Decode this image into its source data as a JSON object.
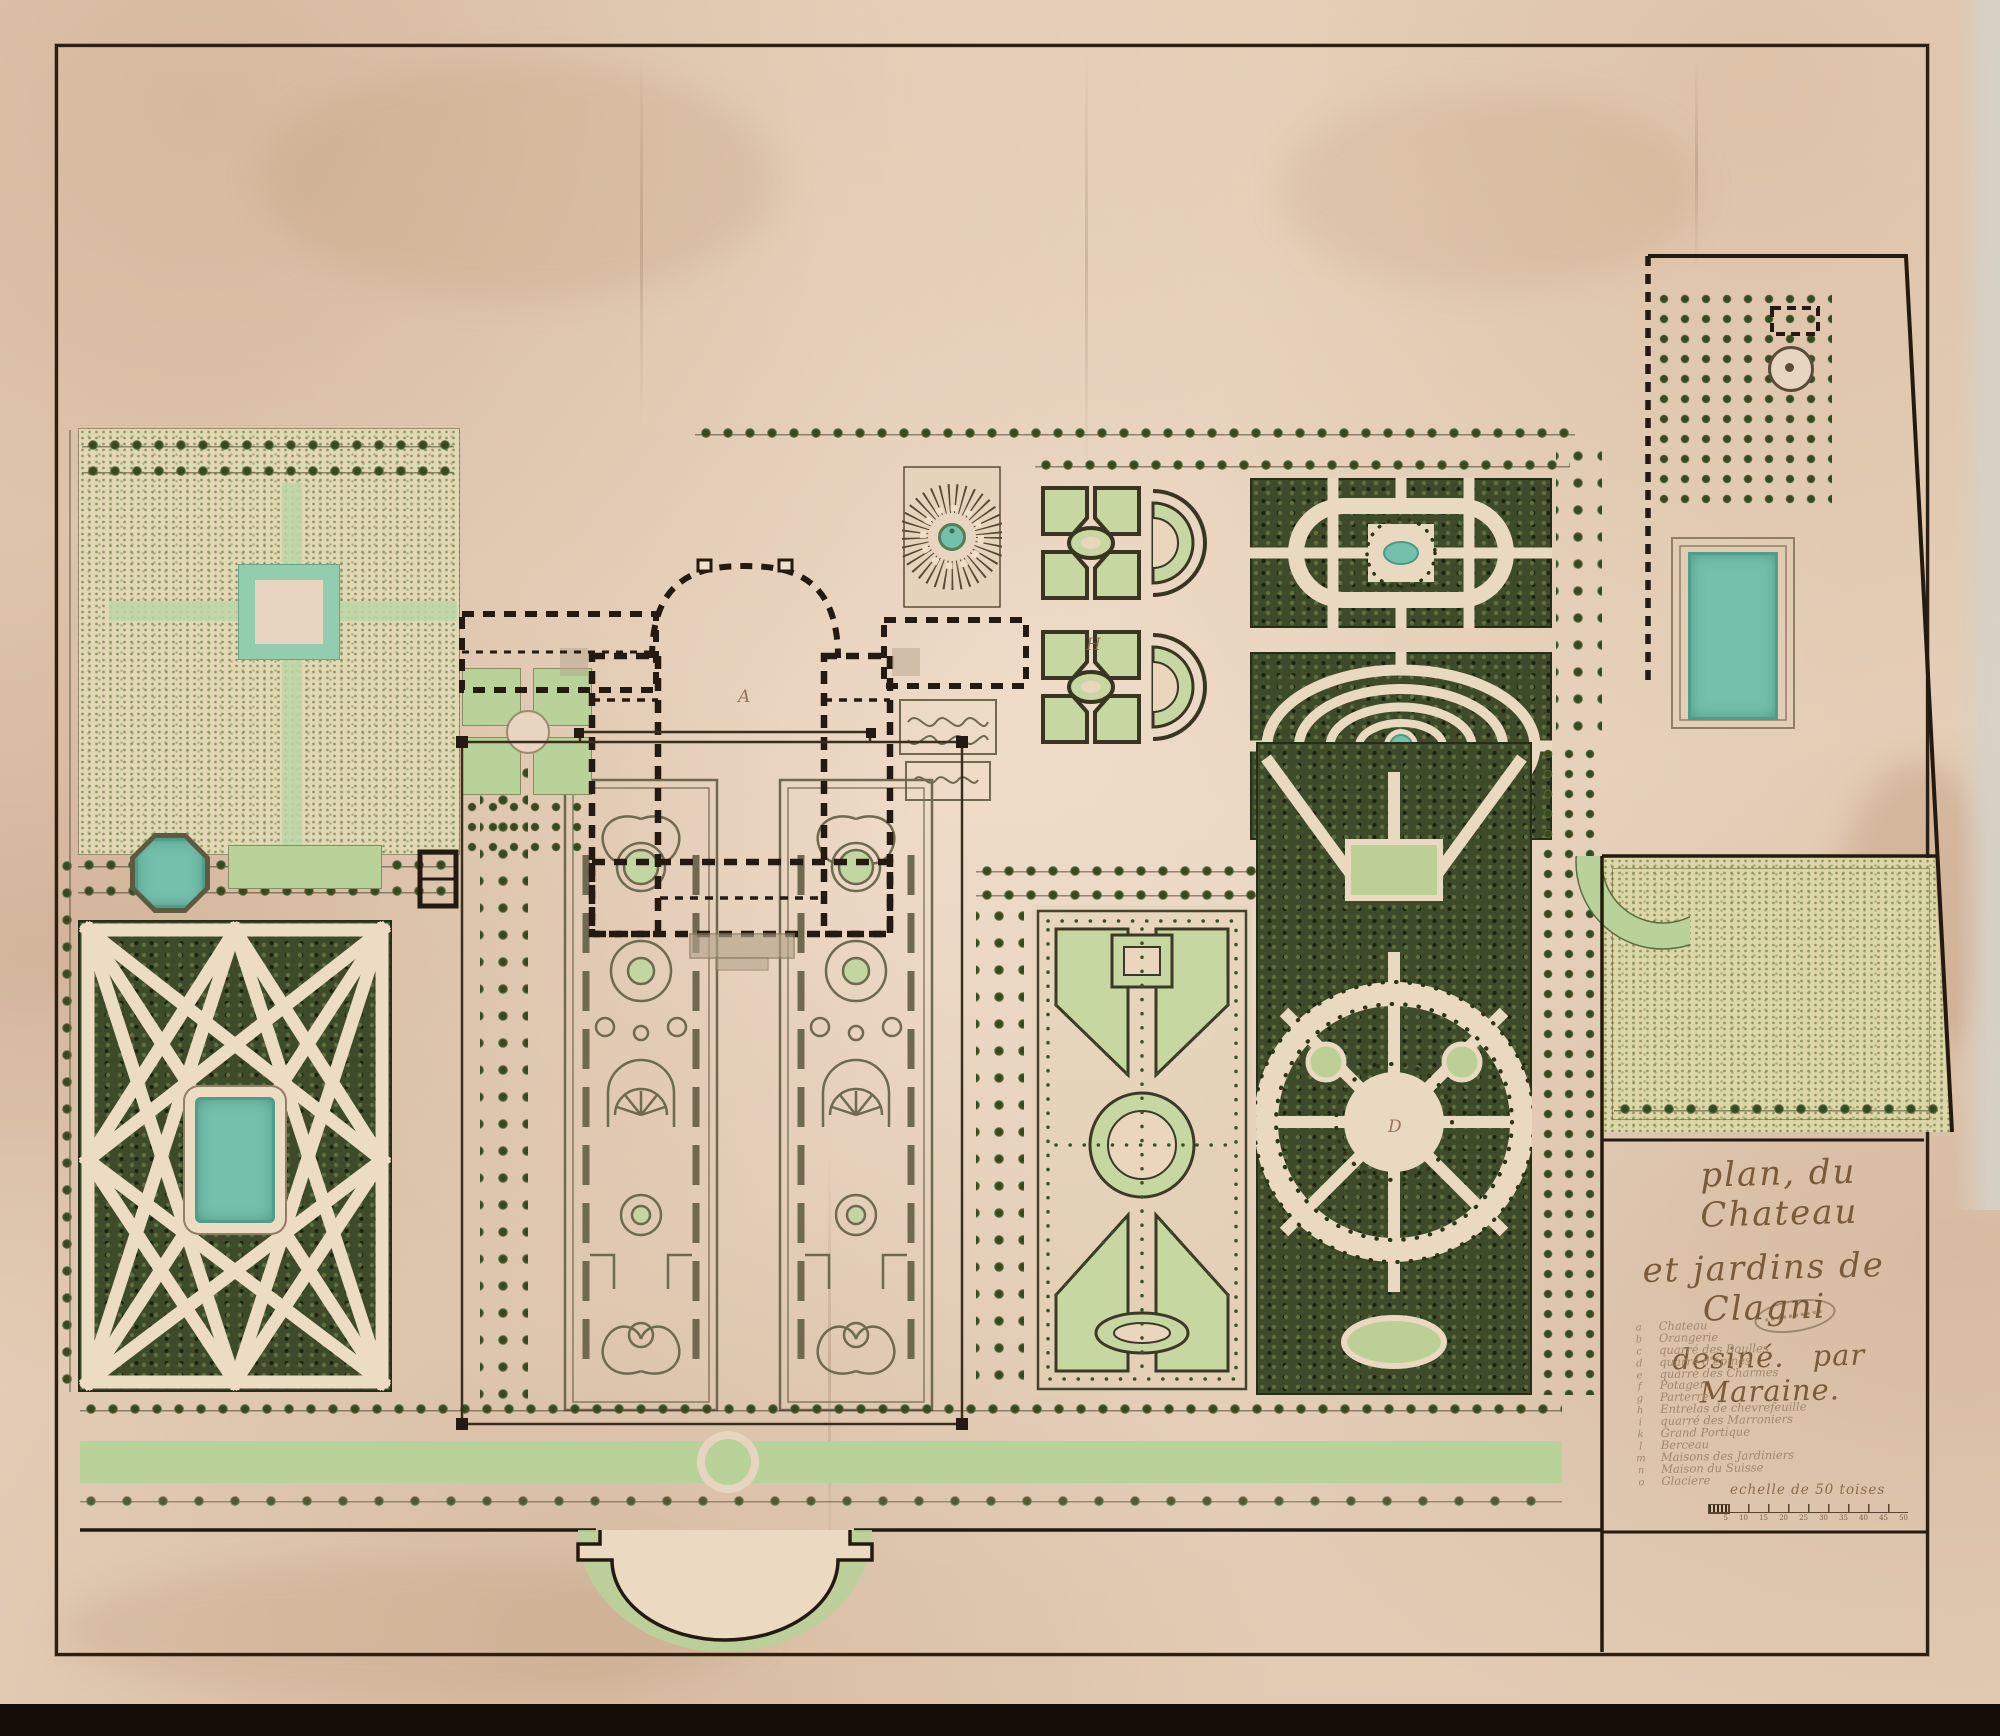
{
  "cartouche": {
    "title": {
      "line1": "plan, du Chateau",
      "line2": "et jardins de Clagni",
      "line3": "desiné. par Maraine."
    },
    "scale": {
      "label": "echelle de 50 toises",
      "ticks": [
        "5",
        "10",
        "15",
        "20",
        "25",
        "30",
        "35",
        "40",
        "45",
        "50"
      ]
    }
  },
  "legend": {
    "items": [
      {
        "key": "a",
        "label": "Chateau"
      },
      {
        "key": "b",
        "label": "Orangerie"
      },
      {
        "key": "c",
        "label": "quarré des Boulles"
      },
      {
        "key": "d",
        "label": "quarré d'épines"
      },
      {
        "key": "e",
        "label": "quarré des Charmes"
      },
      {
        "key": "f",
        "label": "Potager"
      },
      {
        "key": "g",
        "label": "Parterre"
      },
      {
        "key": "h",
        "label": "Entrelas de chevrefeuille"
      },
      {
        "key": "i",
        "label": "quarré des Marroniers"
      },
      {
        "key": "k",
        "label": "Grand Portique"
      },
      {
        "key": "l",
        "label": "Berceau"
      },
      {
        "key": "m",
        "label": "Maisons des Jardiniers"
      },
      {
        "key": "n",
        "label": "Maison du Suisse"
      },
      {
        "key": "o",
        "label": "Glaciere"
      }
    ]
  },
  "letters": {
    "court": "A",
    "alley": "H",
    "rond": "D"
  },
  "colors": {
    "paper": "#e8d4be",
    "ink": "#2b2013",
    "bosquet_green": "#3e4b2a",
    "lawn_green": "#b9d29a",
    "water_turquoise": "#74c0ac",
    "stipple_field": "#e2d8b6"
  }
}
